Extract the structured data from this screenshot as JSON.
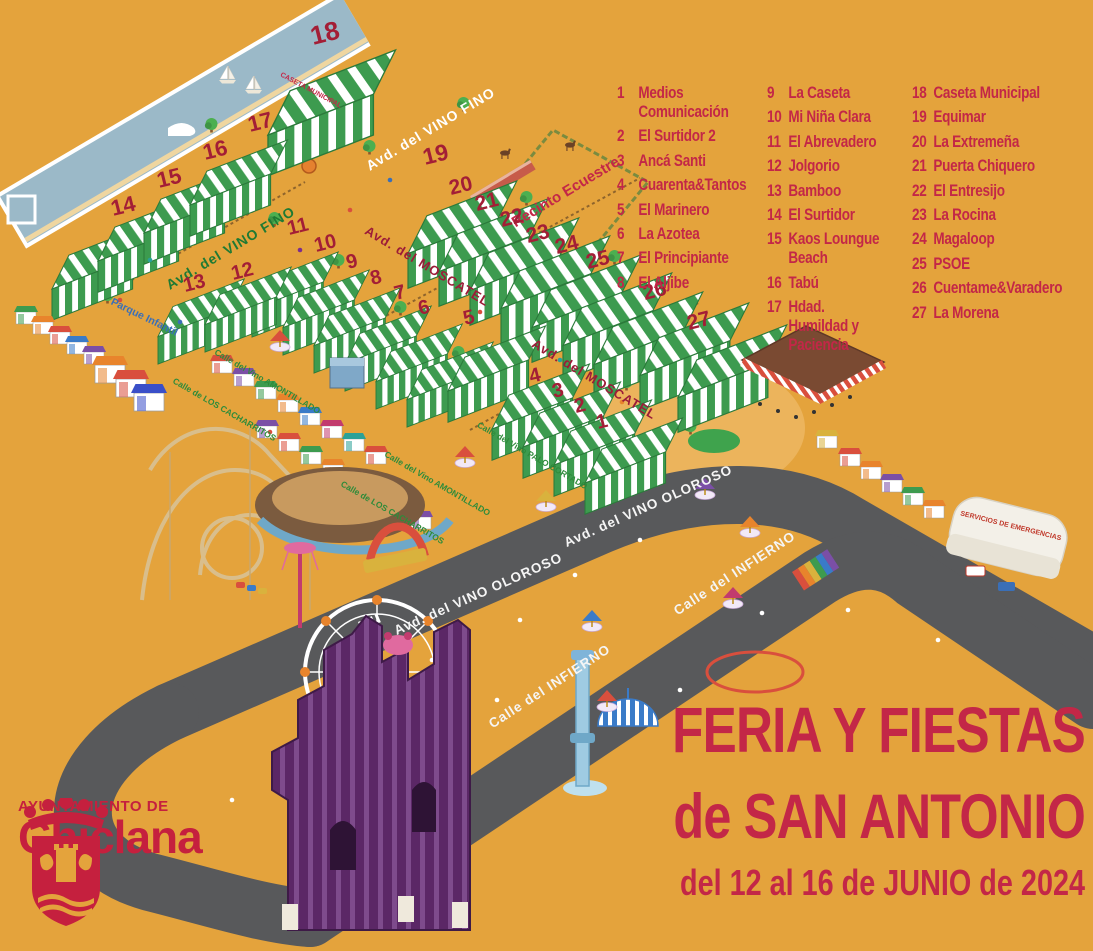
{
  "poster": {
    "title_line1": "FERIA Y FIESTAS",
    "title_line2": "de SAN ANTONIO",
    "title_line3": "del 12 al 16 de JUNIO de 2024"
  },
  "logo": {
    "org": "AYUNTAMIENTO DE",
    "city": "Chiclana"
  },
  "legend": {
    "columns": [
      {
        "items": [
          {
            "num": "1",
            "name": "Medios Comunicación"
          },
          {
            "num": "2",
            "name": "El Surtidor 2"
          },
          {
            "num": "3",
            "name": "Ancá Santi"
          },
          {
            "num": "4",
            "name": "Cuarenta&Tantos"
          },
          {
            "num": "5",
            "name": "El Marinero"
          },
          {
            "num": "6",
            "name": "La Azotea"
          },
          {
            "num": "7",
            "name": "El Principiante"
          },
          {
            "num": "8",
            "name": "El Aljibe"
          }
        ]
      },
      {
        "items": [
          {
            "num": "9",
            "name": "La Caseta"
          },
          {
            "num": "10",
            "name": "Mi Niña Clara"
          },
          {
            "num": "11",
            "name": "El Abrevadero"
          },
          {
            "num": "12",
            "name": "Jolgorio"
          },
          {
            "num": "13",
            "name": "Bamboo"
          },
          {
            "num": "14",
            "name": "El Surtidor"
          },
          {
            "num": "15",
            "name": "Kaos Loungue Beach"
          },
          {
            "num": "16",
            "name": "Tabú"
          },
          {
            "num": "17",
            "name": "Hdad. Humildad y Paciencia"
          }
        ]
      },
      {
        "items": [
          {
            "num": "18",
            "name": "Caseta Municipal"
          },
          {
            "num": "19",
            "name": "Equimar"
          },
          {
            "num": "20",
            "name": "La Extremeña"
          },
          {
            "num": "21",
            "name": "Puerta Chiquero"
          },
          {
            "num": "22",
            "name": "El Entresijo"
          },
          {
            "num": "23",
            "name": "La Rocina"
          },
          {
            "num": "24",
            "name": "Magaloop"
          },
          {
            "num": "25",
            "name": "PSOE"
          },
          {
            "num": "26",
            "name": "Cuentame&Varadero"
          },
          {
            "num": "27",
            "name": "La Morena"
          }
        ]
      }
    ]
  },
  "map": {
    "streets": {
      "vino_fino": "Avd. del VINO FINO",
      "moscatel": "Avd. del MOSCATEL",
      "vino_oloroso": "Avd. del VINO OLOROSO",
      "infierno": "Calle del INFIERNO",
      "amontillado": "Calle del Vino AMONTILLADO",
      "cacharritos": "Calle de LOS CACHARRITOS",
      "palo_cortado": "Calle del Vino PALO CORTADO"
    },
    "areas": {
      "recinto_ecuestre": "Recinto Ecuestre",
      "parque_infantil": "Parque Infantil",
      "caseta_municipal_sign": "CASETA MUNICIPAL",
      "emergencias_sign": "SERVICIOS DE EMERGENCIAS"
    },
    "tent_numbers": [
      "1",
      "2",
      "3",
      "4",
      "5",
      "6",
      "7",
      "8",
      "9",
      "10",
      "11",
      "12",
      "13",
      "14",
      "15",
      "16",
      "17",
      "18",
      "19",
      "20",
      "21",
      "22",
      "23",
      "24",
      "25",
      "26",
      "27"
    ]
  },
  "colors": {
    "background": "#E4A33C",
    "accent_red": "#C32747",
    "number_red": "#A31E36",
    "tent_green": "#3D9B4F",
    "road_gray": "#58595B",
    "water_blue": "#9BB9C8",
    "street_green": "#2E8B3A",
    "street_blue": "#3A6FB7"
  }
}
